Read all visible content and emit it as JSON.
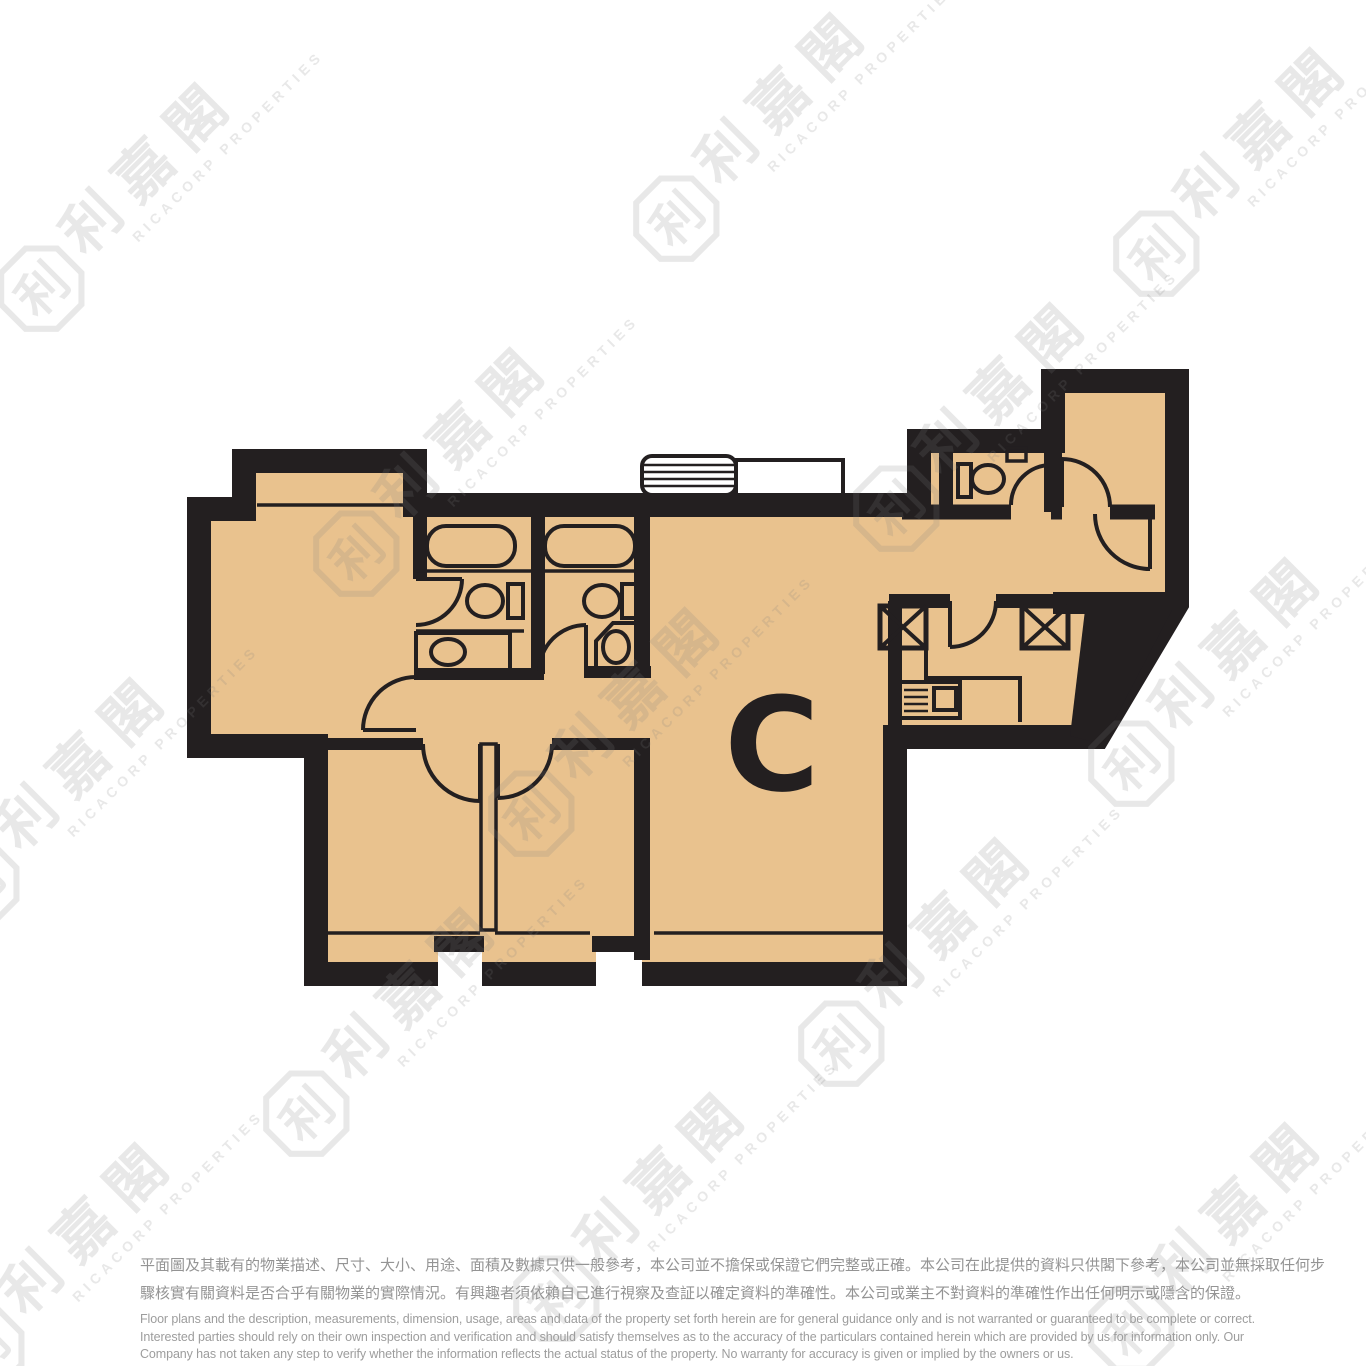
{
  "floorplan": {
    "unit_label": "C",
    "colors": {
      "floor": "#e9c28e",
      "wall": "#231f20",
      "watermark_gray": "#808080",
      "disclaimer_gray": "#969696"
    }
  },
  "watermark": {
    "chinese": "利嘉閣",
    "english": "RICACORP PROPERTIES",
    "logo_glyph": "利"
  },
  "disclaimer": {
    "zh_lines": [
      "平面圖及其載有的物業描述、尺寸、大小、用途、面積及數據只供一般參考，本公司並不擔保或保證它們完整或正確。本公司在此提供的資料只供閣下參考，本公司並無採取任何步",
      "驟核實有關資料是否合乎有關物業的實際情況。有興趣者須依賴自己進行視察及查証以確定資料的準確性。本公司或業主不對資料的準確性作出任何明示或隱含的保證。"
    ],
    "en_lines": [
      "Floor plans and the description, measurements, dimension, usage, areas and data of the property set forth herein are for general guidance only and is not warranted or guaranteed to be complete or correct.",
      "Interested parties should rely on their own inspection and verification and should satisfy themselves as to the accuracy of the particulars contained herein which are provided by us for information only.  Our",
      "Company has not taken any step to verify whether the information reflects the actual status of the property.  No warranty for accuracy is given or implied by the owners or us."
    ]
  }
}
